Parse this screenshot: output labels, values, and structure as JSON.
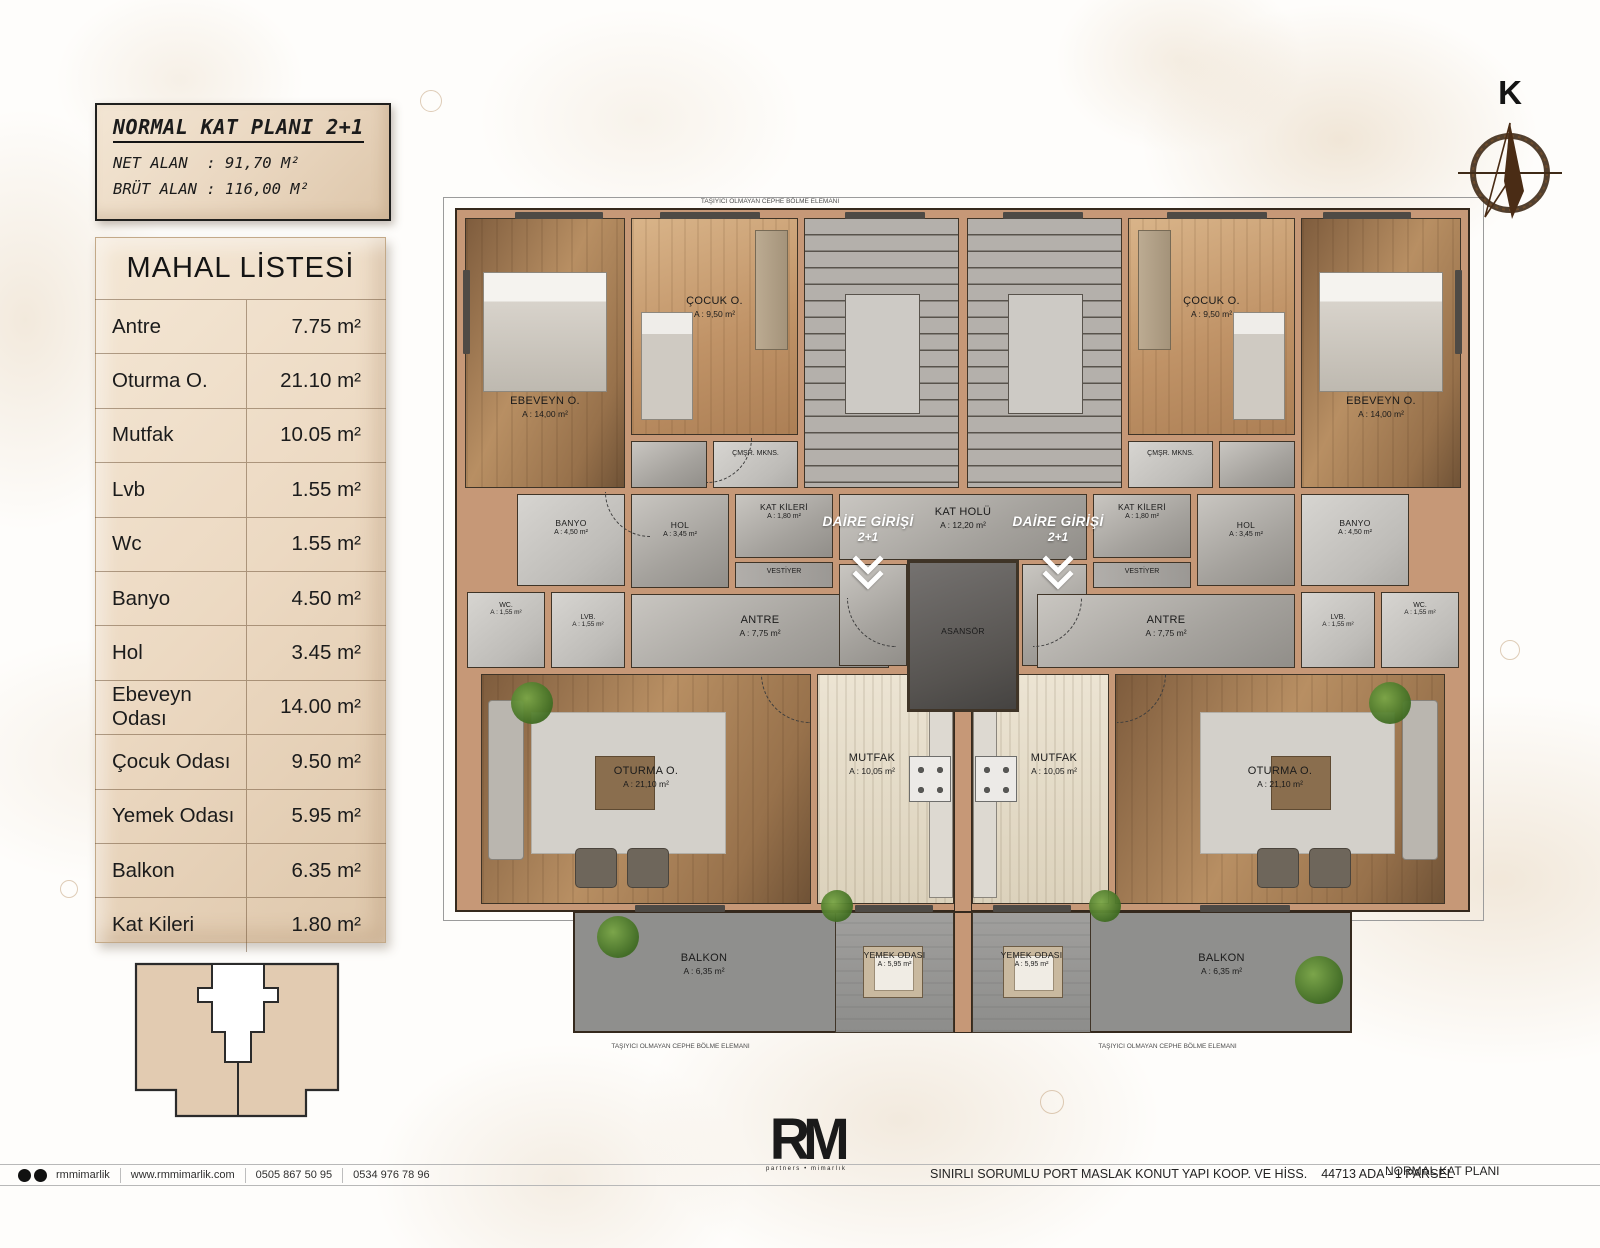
{
  "title_block": {
    "title": "NORMAL KAT PLANI 2+1",
    "line1": "NET ALAN  : 91,70 M²",
    "line2": "BRÜT ALAN : 116,00 M²"
  },
  "mahal_listesi": {
    "title": "MAHAL LİSTESİ",
    "rows": [
      {
        "name": "Antre",
        "area": "7.75 m²"
      },
      {
        "name": "Oturma O.",
        "area": "21.10 m²"
      },
      {
        "name": "Mutfak",
        "area": "10.05 m²"
      },
      {
        "name": "Lvb",
        "area": "1.55 m²"
      },
      {
        "name": "Wc",
        "area": "1.55 m²"
      },
      {
        "name": "Banyo",
        "area": "4.50 m²"
      },
      {
        "name": "Hol",
        "area": "3.45 m²"
      },
      {
        "name": "Ebeveyn Odası",
        "area": "14.00 m²"
      },
      {
        "name": "Çocuk Odası",
        "area": "9.50 m²"
      },
      {
        "name": "Yemek Odası",
        "area": "5.95 m²"
      },
      {
        "name": "Balkon",
        "area": "6.35 m²"
      },
      {
        "name": "Kat Kileri",
        "area": "1.80 m²"
      }
    ]
  },
  "compass": {
    "north_letter": "K"
  },
  "plan": {
    "facade_note": "TAŞIYICI OLMAYAN CEPHE BÖLME ELEMANI",
    "rooms": {
      "ebeveyn": {
        "name": "EBEVEYN O.",
        "area": "A : 14,00 m²"
      },
      "cocuk": {
        "name": "ÇOCUK O.",
        "area": "A : 9,50 m²"
      },
      "cmsr": {
        "name": "ÇMŞR. MKNS."
      },
      "hol": {
        "name": "HOL",
        "area": "A : 3,45 m²"
      },
      "katkileri": {
        "name": "KAT KİLERİ",
        "area": "A : 1,80 m²"
      },
      "banyo": {
        "name": "BANYO",
        "area": "A : 4,50 m²"
      },
      "wc": {
        "name": "WC.",
        "area": "A : 1,55 m²"
      },
      "lvb": {
        "name": "LVB.",
        "area": "A : 1,55 m²"
      },
      "vestiyer": {
        "name": "VESTİYER"
      },
      "antre": {
        "name": "ANTRE",
        "area": "A : 7,75 m²"
      },
      "oturma": {
        "name": "OTURMA O.",
        "area": "A : 21,10 m²"
      },
      "mutfak": {
        "name": "MUTFAK",
        "area": "A : 10,05 m²"
      },
      "yemek": {
        "name": "YEMEK ODASI",
        "area": "A : 5,95 m²"
      },
      "balkon": {
        "name": "BALKON",
        "area": "A : 6,35 m²"
      },
      "kat_holu": {
        "name": "KAT HOLÜ",
        "area": "A : 12,20 m²"
      },
      "asansor": {
        "name": "ASANSÖR"
      },
      "daire_girisi": {
        "name": "DAİRE GİRİŞİ",
        "sub": "2+1"
      }
    }
  },
  "footer": {
    "brand": "rmmimarlik",
    "website": "www.rmmimarlik.com",
    "phone1": "0505 867 50 95",
    "phone2": "0534 976 78 96",
    "logo_text": "RM",
    "logo_sub": "partners • mimarlık",
    "project": "SINIRLI SORUMLU PORT MASLAK KONUT YAPI KOOP. VE HİSS.",
    "parcel": "44713 ADA - 1 PARSEL",
    "plan_name": "NORMAL KAT PLANI"
  }
}
